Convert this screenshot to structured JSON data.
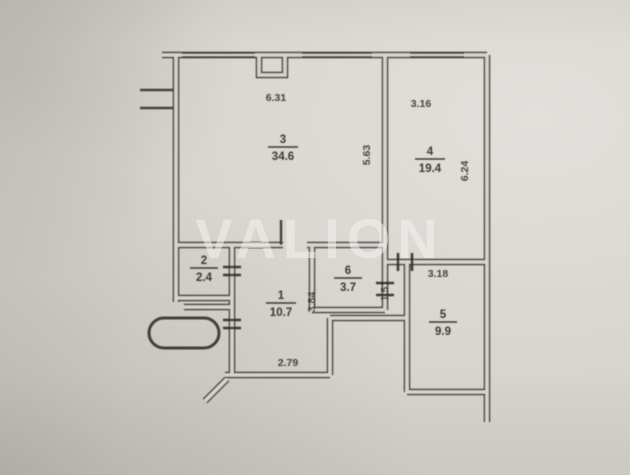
{
  "floor_plan": {
    "watermark": "VALION",
    "rooms": [
      {
        "number": "3",
        "area": "34.6"
      },
      {
        "number": "4",
        "area": "19.4"
      },
      {
        "number": "2",
        "area": "2.4"
      },
      {
        "number": "1",
        "area": "10.7"
      },
      {
        "number": "6",
        "area": "3.7"
      },
      {
        "number": "5",
        "area": "9.9"
      }
    ],
    "dimensions": {
      "room3_top_width": "6.31",
      "room4_top_width": "3.16",
      "mid_wall_height": "5.63",
      "room4_right_height": "6.24",
      "room2_height_note": "",
      "room1_width": "2.79",
      "room1_height": "3.84",
      "niche_height": "1.51",
      "room5_top_width": "3.18"
    },
    "colors": {
      "paper": "#d7d4ce",
      "ink": "#34322e",
      "watermark": "#f4f3ef"
    }
  }
}
